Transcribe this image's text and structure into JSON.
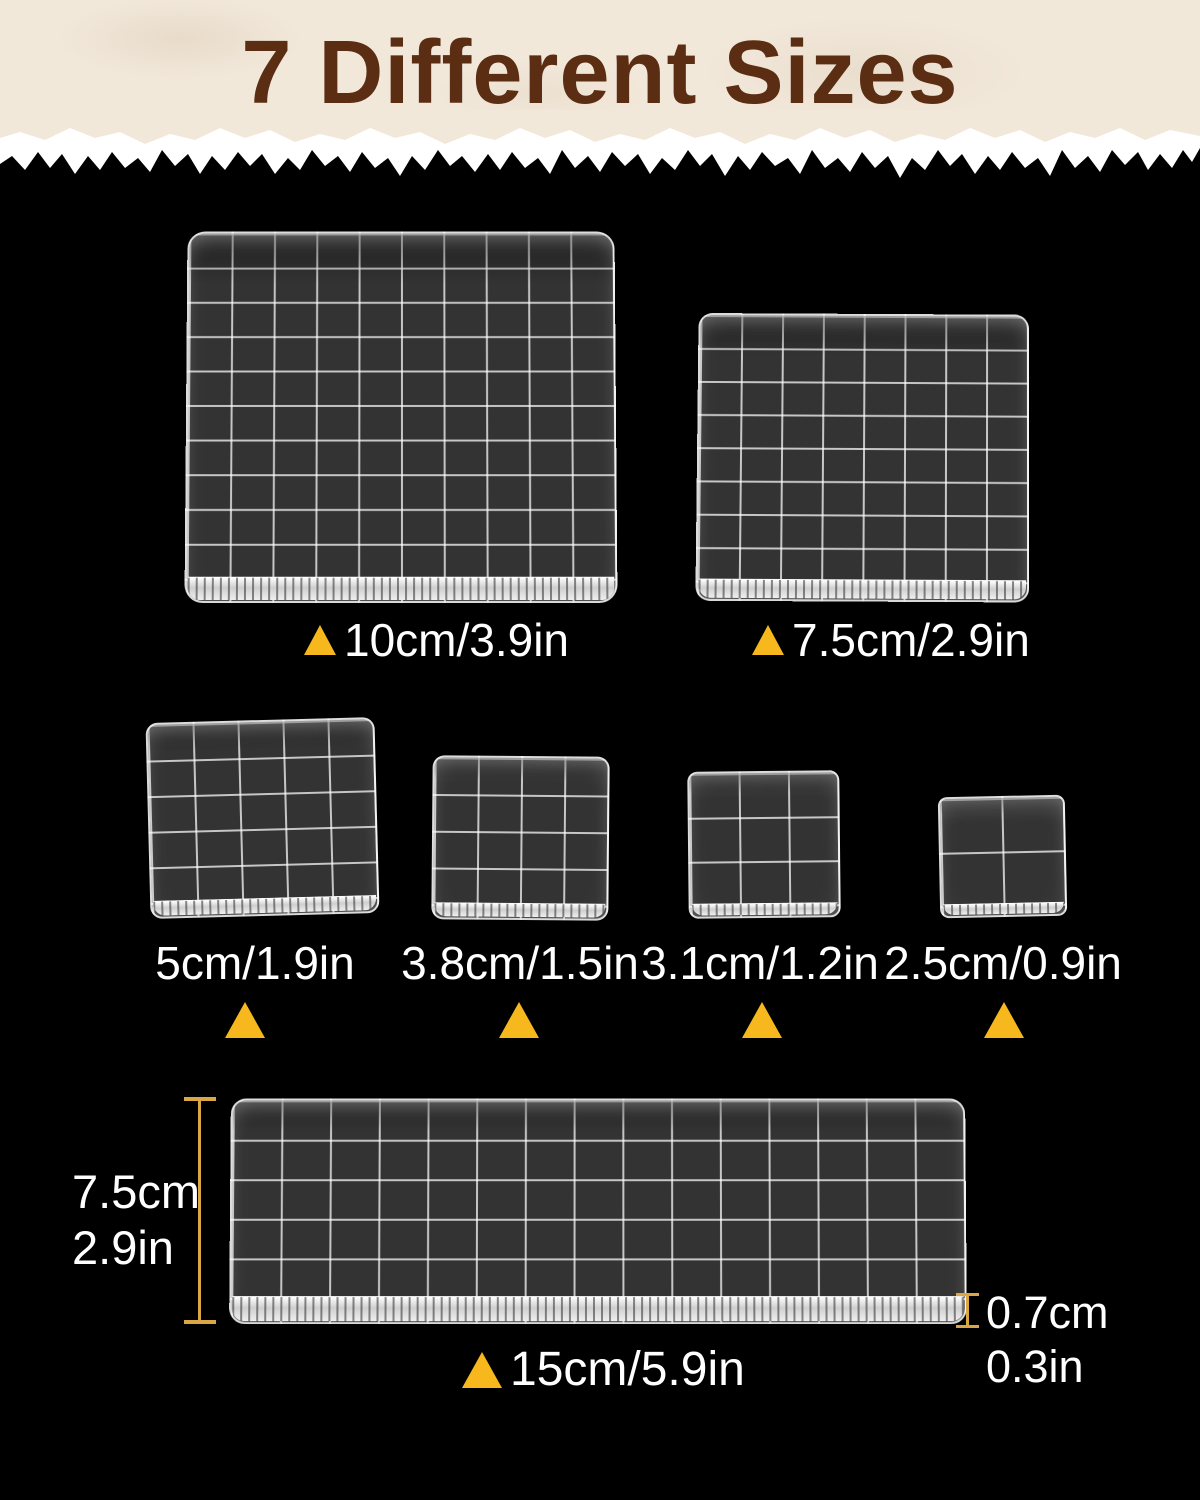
{
  "title": "7 Different Sizes",
  "colors": {
    "background": "#000000",
    "header_background": "#F2E8DA",
    "title_text": "#5B2D12",
    "label_text": "#FFFFFF",
    "triangle": "#F6B81C",
    "measure_line": "#D9A845"
  },
  "blocks": [
    {
      "key": "10cm",
      "label": "10cm/3.9in",
      "grid_cols": 10,
      "grid_rows": 10
    },
    {
      "key": "7.5cm",
      "label": "7.5cm/2.9in",
      "grid_cols": 8,
      "grid_rows": 8
    },
    {
      "key": "5cm",
      "label": "5cm/1.9in",
      "grid_cols": 5,
      "grid_rows": 5
    },
    {
      "key": "3.8cm",
      "label": "3.8cm/1.5in",
      "grid_cols": 4,
      "grid_rows": 4
    },
    {
      "key": "3.1cm",
      "label": "3.1cm/1.2in",
      "grid_cols": 3,
      "grid_rows": 3
    },
    {
      "key": "2.5cm",
      "label": "2.5cm/0.9in",
      "grid_cols": 2,
      "grid_rows": 2
    },
    {
      "key": "15cm",
      "label": "15cm/5.9in",
      "grid_cols": 15,
      "grid_rows": 5
    }
  ],
  "measurements": {
    "left_height_cm": "7.5cm",
    "left_height_in": "2.9in",
    "thickness_cm": "0.7cm",
    "thickness_in": "0.3in"
  }
}
